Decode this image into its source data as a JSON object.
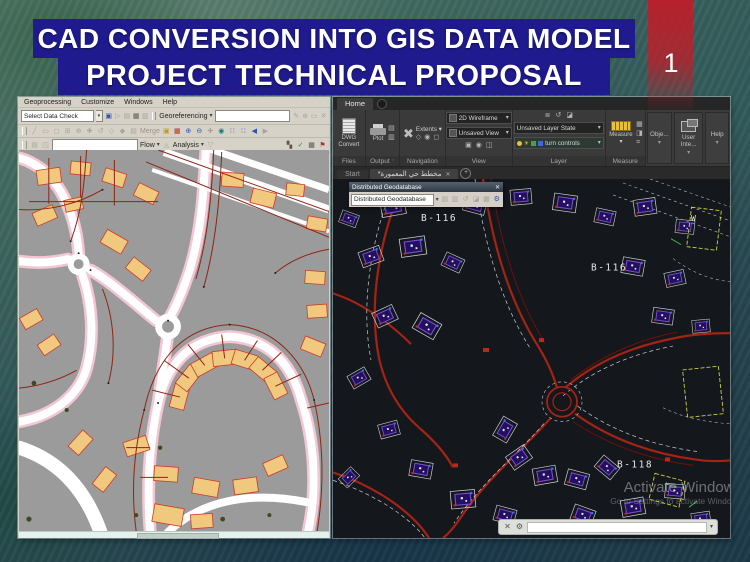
{
  "slide": {
    "title_line1": "CAD CONVERSION INTO GIS DATA MODEL",
    "title_line2": "PROJECT TECHNICAL PROPOSAL",
    "page_number": "1"
  },
  "arcmap": {
    "menus": [
      "Geoprocessing",
      "Customize",
      "Windows",
      "Help"
    ],
    "standard_toolbar": {
      "combo_value": "Select Data Check"
    },
    "georeferencing": {
      "label": "Georeferencing"
    },
    "editor_toolbar": {
      "merge_label": "Merge"
    },
    "flow_toolbar": {
      "flow_label": "Flow",
      "analysis_label": "Analysis"
    }
  },
  "autocad": {
    "tabs": {
      "home": "Home"
    },
    "panels": {
      "files_label": "Files",
      "dwg_convert": "DWG Convert",
      "output_label": "Output",
      "plot": "Plot",
      "navigation_label": "Navigation",
      "extents": "Extents",
      "view_label": "View",
      "visual_style": "2D Wireframe",
      "view_combo": "Unsaved View",
      "layer_label": "Layer",
      "layer_state": "Unsaved Layer State",
      "current_layer": "turn controls",
      "measure_label": "Measure",
      "measure_button": "Measure",
      "objects_label": "Obje...",
      "user_interface_label": "User Inte...",
      "help_label": "Help"
    },
    "file_tabs": {
      "start": "Start",
      "drawing": "*مخطط حي المعمورة"
    },
    "geodatabase_toolbar": {
      "title": "Distributed Geodatabase",
      "combo": "Distributed Geodatabase"
    },
    "labels": {
      "b116_a": "B-116",
      "b116_b": "B-116",
      "b118": "B-118",
      "compass_w": "W"
    },
    "watermark": {
      "line1": "Activate Windows",
      "line2": "Go to Settings to activate Windows"
    }
  },
  "colors": {
    "banner_blue": "#1f1b8e",
    "stripe_red": "#c11c28",
    "map_background": "#9b9b9b",
    "map_building": "#f0c87e",
    "parcel_red": "#8e2413",
    "cad_background": "#14171c",
    "cad_road_red": "#a42314",
    "cad_building_purple": "#7a4fd2",
    "ribbon_gray": "#3a3a3a",
    "accent_yellow": "#e8c13a"
  }
}
